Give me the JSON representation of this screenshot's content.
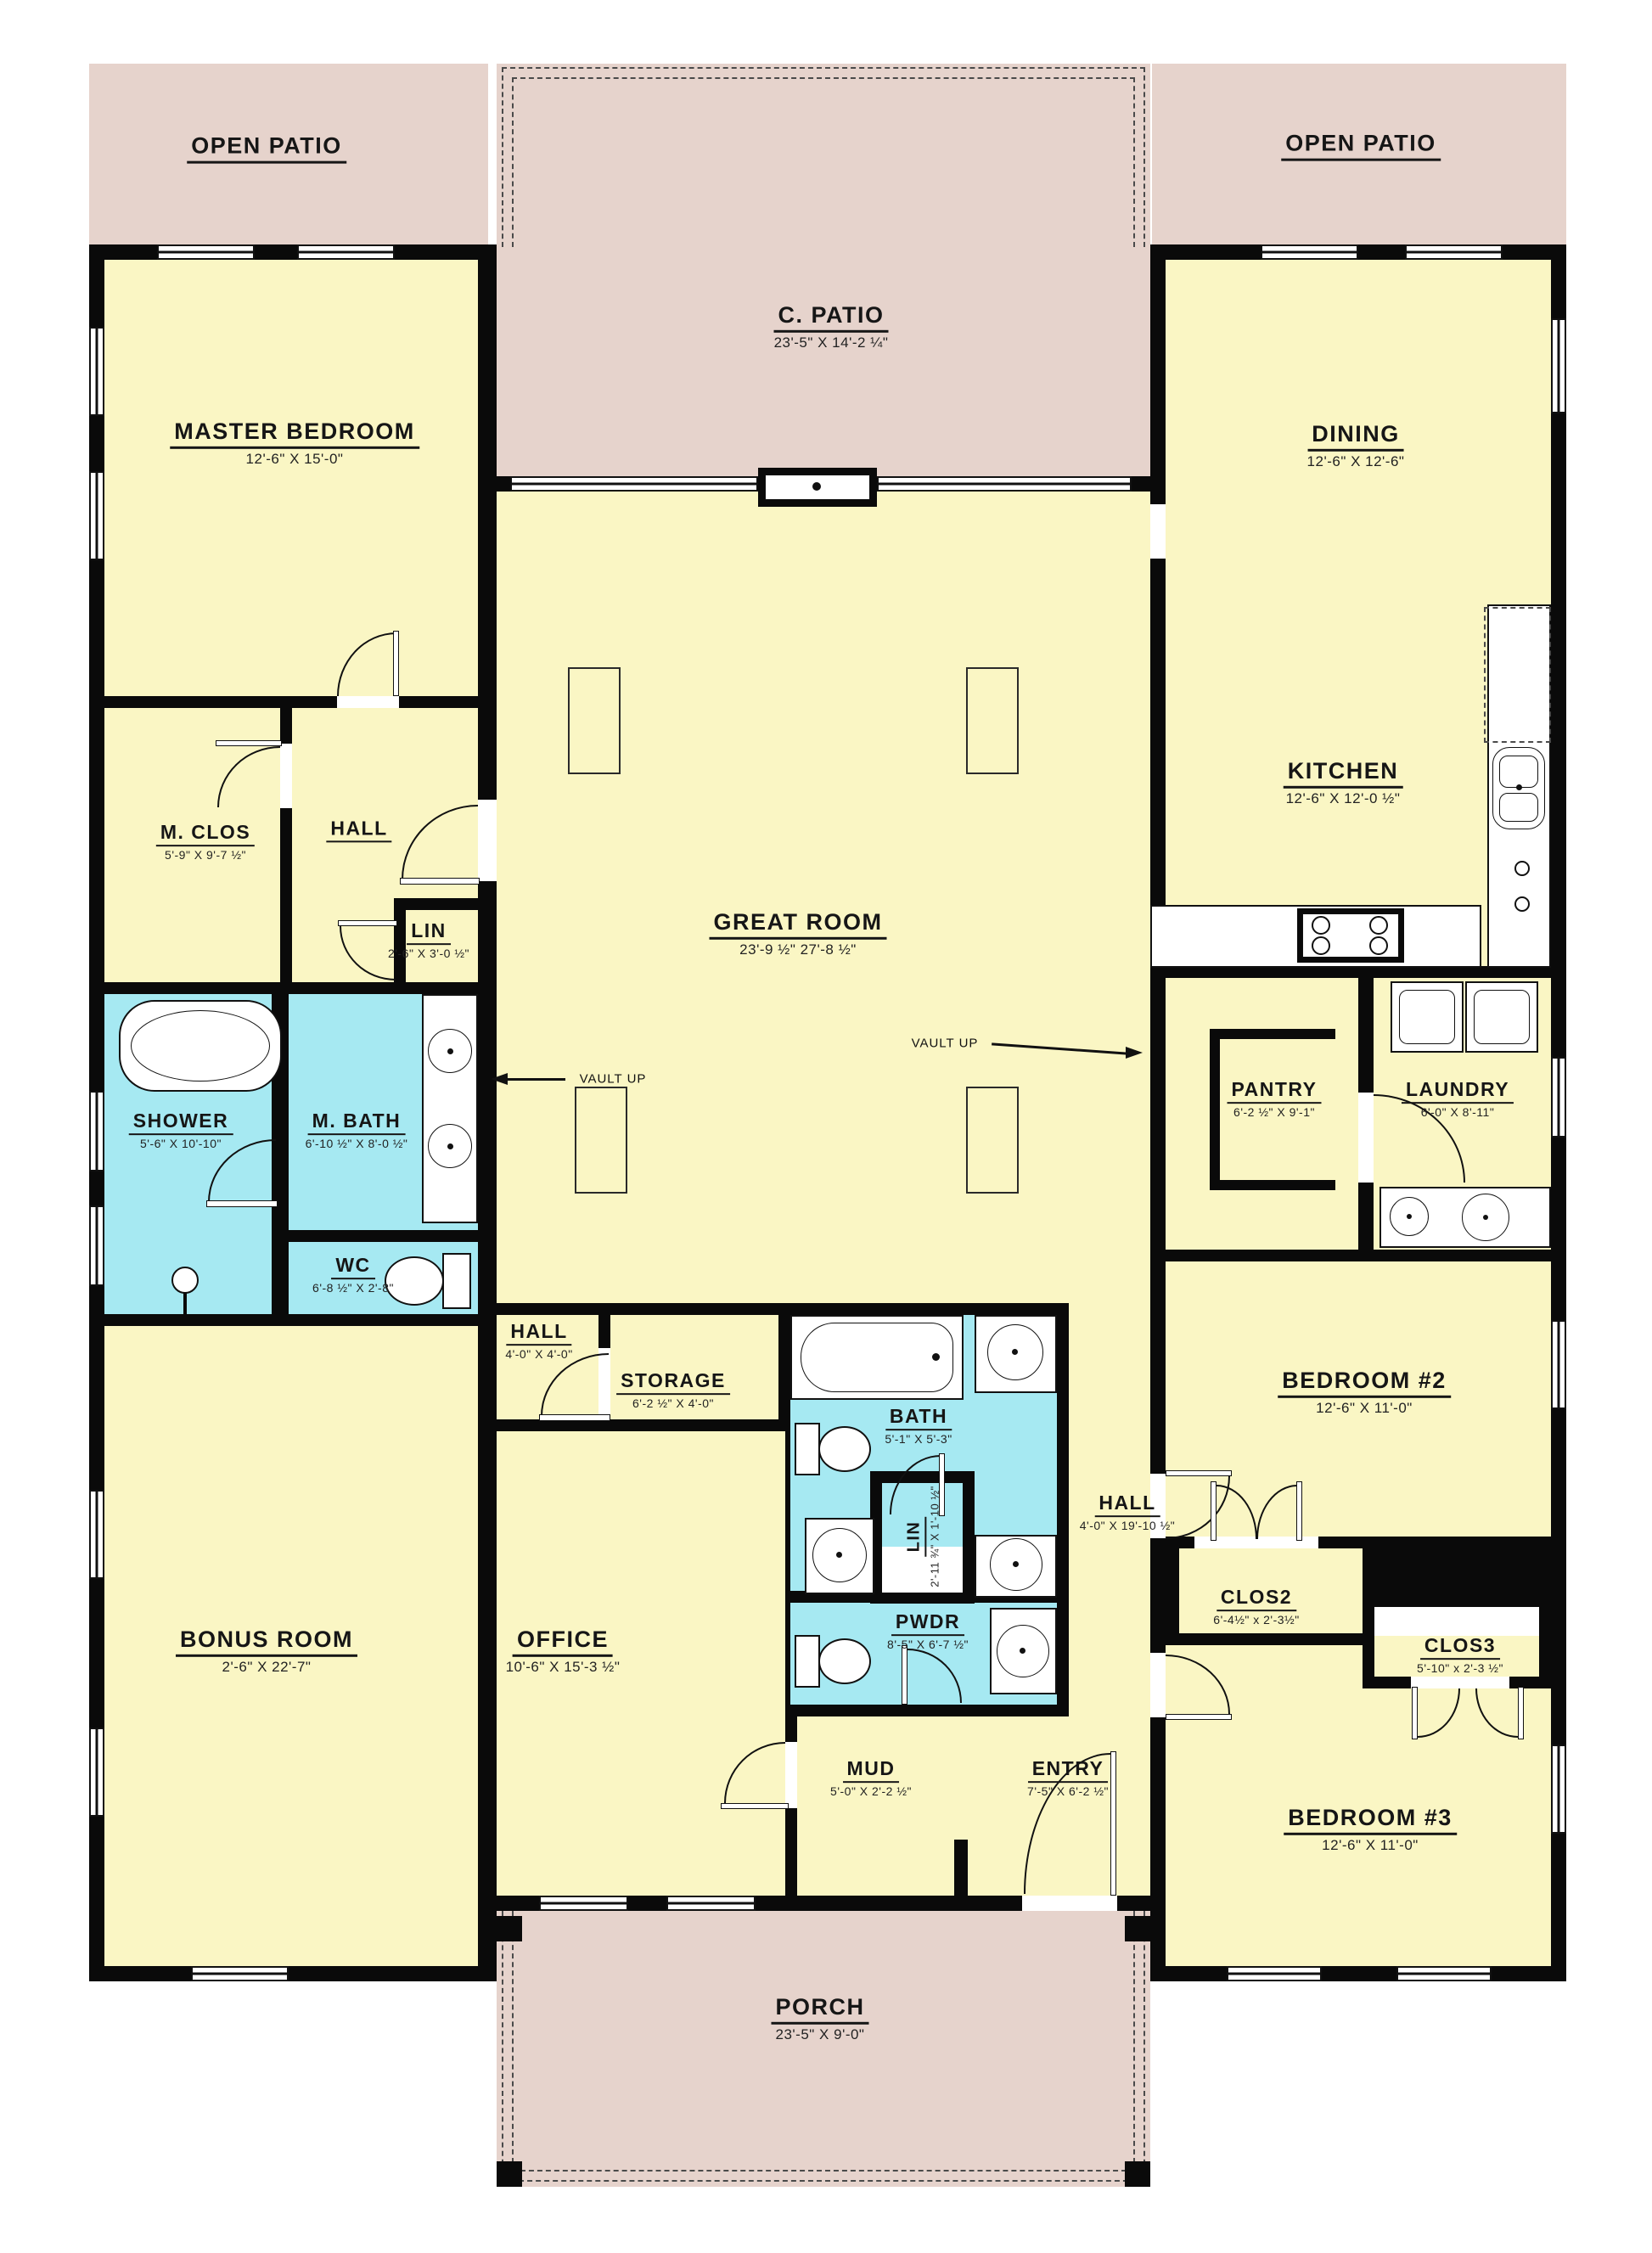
{
  "colors": {
    "floor_yellow": "#faf6c4",
    "bath_cyan": "#a6e9f2",
    "patio_pink": "#e6d3cc",
    "wall_black": "#0a0a0a",
    "background": "#ffffff"
  },
  "rooms": {
    "open_patio_left": {
      "label": "OPEN PATIO"
    },
    "open_patio_right": {
      "label": "OPEN PATIO"
    },
    "c_patio": {
      "label": "C. PATIO",
      "dims": "23'-5\" X 14'-2 ¼\""
    },
    "master_bedroom": {
      "label": "MASTER BEDROOM",
      "dims": "12'-6\" X 15'-0\""
    },
    "dining": {
      "label": "DINING",
      "dims": "12'-6\" X 12'-6\""
    },
    "kitchen": {
      "label": "KITCHEN",
      "dims": "12'-6\" X 12'-0 ½\""
    },
    "great_room": {
      "label": "GREAT ROOM",
      "dims": "23'-9 ½\" 27'-8 ½\""
    },
    "m_clos": {
      "label": "M. CLOS",
      "dims": "5'-9\" X 9'-7 ½\""
    },
    "hall_master": {
      "label": "HALL"
    },
    "lin_master": {
      "label": "LIN",
      "dims": "2'-6\" X 3'-0 ½\""
    },
    "shower": {
      "label": "SHOWER",
      "dims": "5'-6\" X 10'-10\""
    },
    "m_bath": {
      "label": "M. BATH",
      "dims": "6'-10 ½\" X 8'-0 ½\""
    },
    "wc": {
      "label": "WC",
      "dims": "6'-8 ½\" X 2'-8\""
    },
    "pantry": {
      "label": "PANTRY",
      "dims": "6'-2 ½\" X 9'-1\""
    },
    "laundry": {
      "label": "LAUNDRY",
      "dims": "6'-0\" X 8'-11\""
    },
    "bedroom2": {
      "label": "BEDROOM #2",
      "dims": "12'-6\" X 11'-0\""
    },
    "hall_center": {
      "label": "HALL",
      "dims": "4'-0\" X 4'-0\""
    },
    "storage": {
      "label": "STORAGE",
      "dims": "6'-2 ½\" X 4'-0\""
    },
    "bath": {
      "label": "BATH",
      "dims": "5'-1\" X 5'-3\""
    },
    "hall_right": {
      "label": "HALL",
      "dims": "4'-0\" X 19'-10 ½\""
    },
    "lin_hall": {
      "label": "LIN",
      "dims": "2'-11 ¾\" X 1'-10 ½\""
    },
    "pwdr": {
      "label": "PWDR",
      "dims": "8'-5\" X 6'-7 ½\""
    },
    "clos2": {
      "label": "CLOS2",
      "dims": "6'-4½\" x 2'-3½\""
    },
    "clos3": {
      "label": "CLOS3",
      "dims": "5'-10\" x 2'-3 ½\""
    },
    "bonus_room": {
      "label": "BONUS ROOM",
      "dims": "2'-6\" X 22'-7\""
    },
    "office": {
      "label": "OFFICE",
      "dims": "10'-6\" X 15'-3 ½\""
    },
    "mud": {
      "label": "MUD",
      "dims": "5'-0\" X 2'-2 ½\""
    },
    "entry": {
      "label": "ENTRY",
      "dims": "7'-5\" X 6'-2 ½\""
    },
    "bedroom3": {
      "label": "BEDROOM #3",
      "dims": "12'-6\" X 11'-0\""
    },
    "porch": {
      "label": "PORCH",
      "dims": "23'-5\" X 9'-0\""
    }
  },
  "annotations": {
    "vault_up_left": "VAULT UP",
    "vault_up_right": "VAULT UP"
  }
}
